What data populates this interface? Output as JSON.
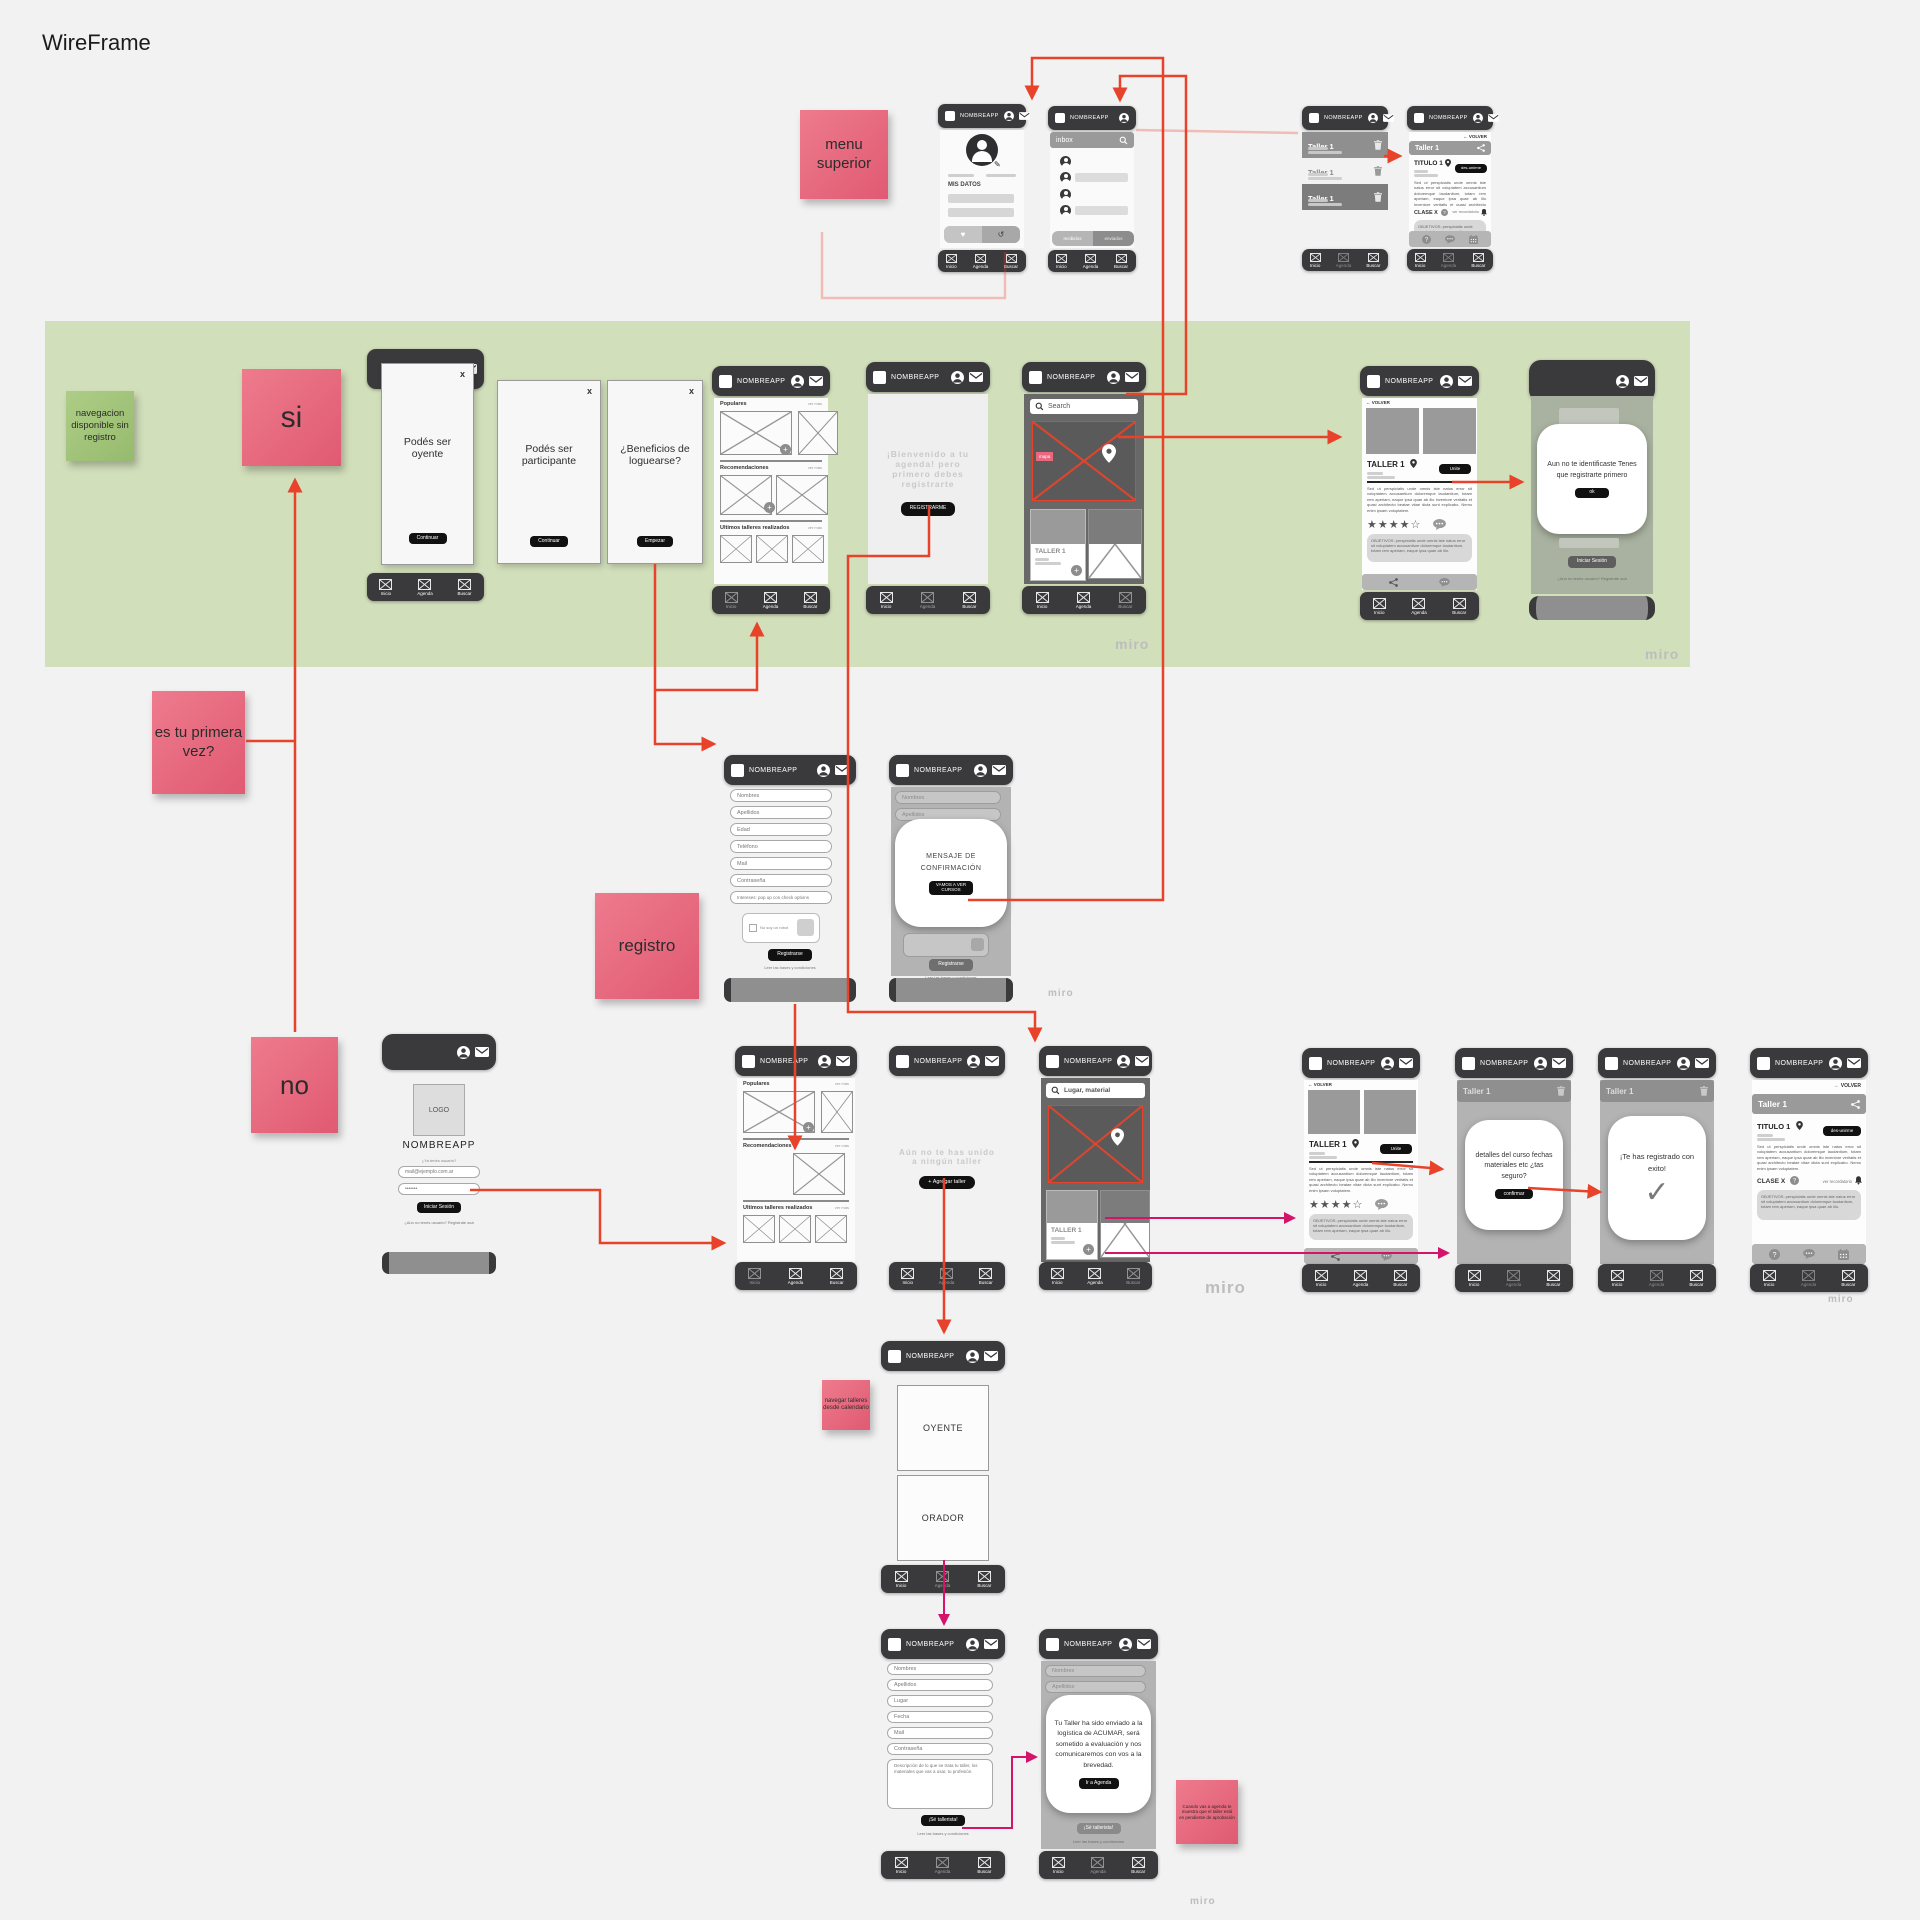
{
  "title": "WireFrame",
  "watermark": "miro",
  "colors": {
    "arrow_red": "#e8432a",
    "arrow_pink": "#d4136b",
    "sticky_pink": "#e8697d",
    "sticky_green": "#a5c57d",
    "band_green": "#d2dfbb",
    "phone_dark": "#3a3a3c",
    "map_tag_pink": "#e8697d"
  },
  "stickies": {
    "menu_superior": "menu superior",
    "si": "si",
    "no": "no",
    "primera_vez": "es tu primera vez?",
    "registro": "registro",
    "nav_disponible": "navegacion disponible sin registro",
    "navegar_talleres": "navegar talleres desde calendario",
    "pendiente": "Cuando vas a agenda te muestra que el taller está en pendiente de aprobación"
  },
  "common": {
    "app": "NOMBREAPP",
    "nav_inicio": "Inicio",
    "nav_agenda": "Agenda",
    "nav_buscar": "Buscar",
    "ver_mas": "ver más",
    "volver": "← VOLVER",
    "taller": "Taller 1",
    "taller_caps": "TALLER 1",
    "titulo": "TITULO 1",
    "clase": "CLASE X",
    "recordatorio": "ver recordatorio",
    "unirse": "Unite",
    "desunirse": "des-unirme",
    "continuar": "Continuar",
    "close": "x",
    "stars": "★★★★☆",
    "lorem": "Sed ut perspiciatis unde omnis iste natus error sit voluptatem accusantium doloremque laudantium, totam rem aperiam, eaque ipsa quae ab illo inventore veritatis et quasi architecto beatae vitae dicta sunt explicabo. Nemo enim ipsam voluptatem.",
    "objetivos": "OBJETIVOS: perspiciatis unde omnis iste natus error sit voluptatem accusantium doloremque laudantium, totam rem aperiam, eaque ipsa quae ab illo.",
    "bases": "Leer las bases y condiciones"
  },
  "perfil": {
    "mis_datos": "MIS DATOS",
    "fav_icon": "♥",
    "hist_icon": "↺",
    "edit_icon": "✎"
  },
  "inbox": {
    "title": "inbox",
    "tab_recibidos": "recibidos",
    "tab_enviados": "enviados"
  },
  "feed": {
    "populares": "Populares",
    "recomendaciones": "Recomendaciones",
    "ultimos": "Ultimos talleres realizados"
  },
  "onboarding": {
    "oyente": "Podés ser oyente",
    "participante": "Podés ser participante",
    "beneficios": "¿Beneficios de loguearse?",
    "empezar": "Empezar"
  },
  "welcome": {
    "text": "¡Bienvenido a tu agenda! pero primero debes registrarte",
    "cta": "REGISTRARME"
  },
  "search": {
    "placeholder": "Search",
    "placeholder2": "Lugar, material",
    "mapa": "mapa"
  },
  "identificate": {
    "text": "Aun no te identificaste Tenes que registrarte primero",
    "ok": "ok"
  },
  "login": {
    "logo": "LOGO",
    "label": "¿Ya tenés usuario?",
    "mail": "mail@ejemplo.com.ar",
    "pass": "•••••••",
    "cta": "Iniciar Sesión",
    "footer": "¿Aún no tenés usuario? Registrate acá"
  },
  "registro": {
    "f1": "Nombres",
    "f2": "Apellidos",
    "f3": "Edad",
    "f4": "Teléfono",
    "f5": "Mail",
    "f6": "Contraseña",
    "f7": "Intereses: pop up con check options",
    "captcha": "No soy un robot",
    "cta": "Registrarse",
    "modal": "MENSAJE DE CONFIRMACIÓN",
    "modal_cta": "VAMOS A VER CURSOS"
  },
  "agenda": {
    "empty": "Aún no te has unido a ningún taller",
    "add": "+ Agregar taller"
  },
  "confirm": {
    "text": "detalles del curso fechas materiales etc ¿tas seguro?",
    "cta": "confirmar"
  },
  "success": {
    "text": "¡Te has registrado con exito!",
    "check": "✓"
  },
  "roles": {
    "oyente": "OYENTE",
    "orador": "ORADOR"
  },
  "orador_form": {
    "f1": "Nombres",
    "f2": "Apellidos",
    "f3": "Lugar",
    "f4": "Fecha",
    "f5": "Mail",
    "f6": "Contraseña",
    "desc": "Descripción de lo que se trata tu taller, los materiales que vas a usar, tu profesión.",
    "cta": "¡Sé tallerista!"
  },
  "sent": {
    "text": "Tu Taller ha sido enviado a la logística de ACUMAR, será sometido a evaluación y nos comunicaremos con vos a la brevedad.",
    "cta": "Ir a Agenda"
  }
}
